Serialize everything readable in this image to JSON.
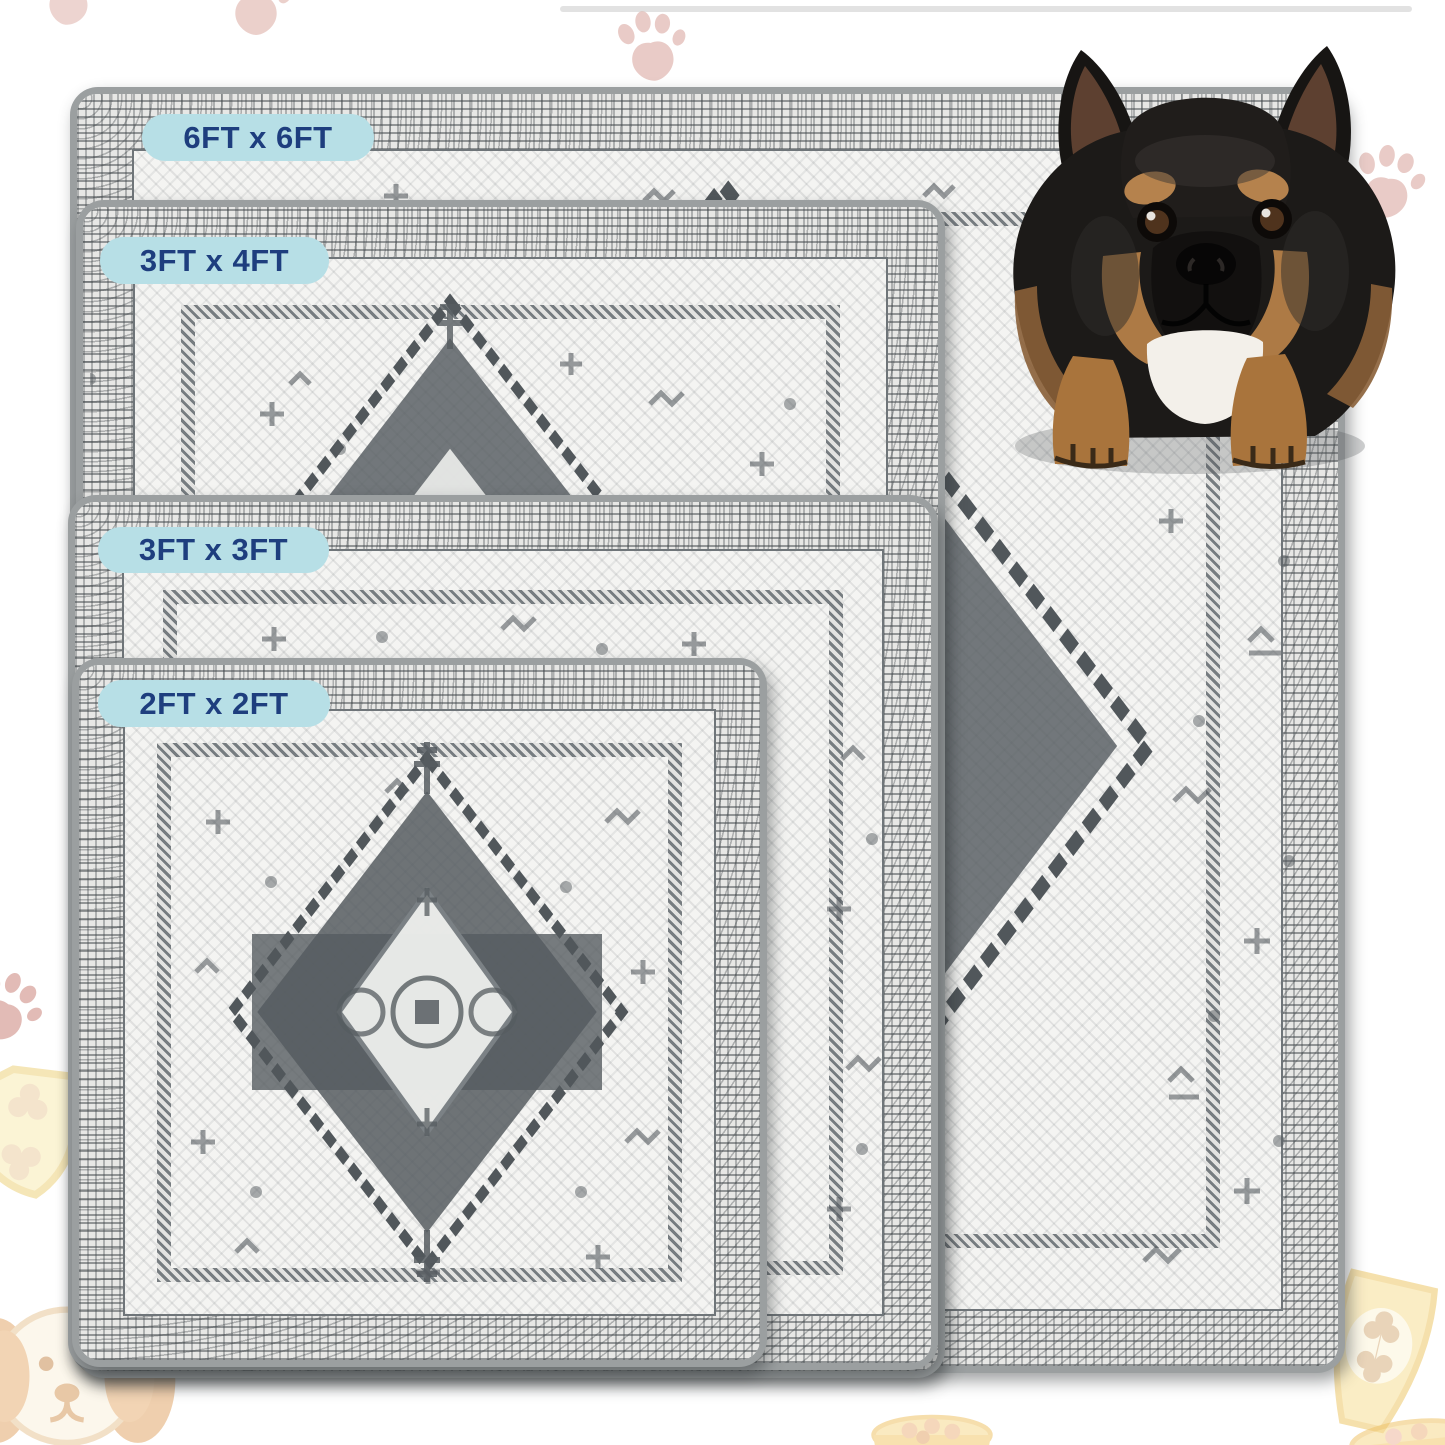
{
  "image": {
    "description": "Pet area rug size comparison photo with four stacked rugs and a French Bulldog",
    "rug_style": "distressed grey vintage medallion rug with grey binding"
  },
  "size_labels": [
    {
      "id": "6x6",
      "text": "6FT x 6FT"
    },
    {
      "id": "3x4",
      "text": "3FT x 4FT"
    },
    {
      "id": "3x3",
      "text": "3FT x 3FT"
    },
    {
      "id": "2x2",
      "text": "2FT x 2FT"
    }
  ],
  "colors": {
    "badge_bg": "#b7dfe6",
    "badge_text": "#1e3e7e",
    "rug_binding": "#9b9fa0",
    "rug_border_band": "#e7e7e5",
    "rug_field": "#f4f4f2",
    "pattern_ink": "#50565a",
    "paw_print_pink": "#dcaaa2",
    "food_doodle_yellow": "#f6df9e",
    "dog_coat": "#1c1a18",
    "dog_tan": "#b5824d",
    "dog_chest": "#f3f0ea"
  },
  "background_icons": [
    {
      "name": "paw-print-icon"
    },
    {
      "name": "shield-bone-icon"
    },
    {
      "name": "dog-face-icon"
    },
    {
      "name": "food-bowl-icon"
    },
    {
      "name": "treat-bag-icon"
    }
  ],
  "dog": {
    "name": "french-bulldog",
    "pose": "sitting on top-right corner of largest rug, looking up"
  }
}
